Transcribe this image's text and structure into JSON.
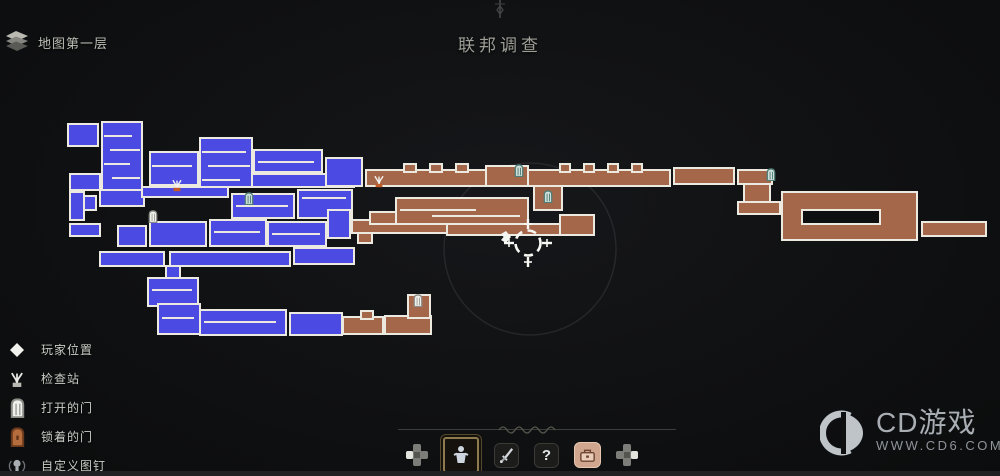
{
  "header": {
    "map_layer_label": "地图第一层",
    "title": "联邦调查"
  },
  "legend": {
    "items": [
      {
        "icon": "player-icon",
        "label": "玩家位置"
      },
      {
        "icon": "checkpoint-icon",
        "label": "检查站"
      },
      {
        "icon": "open-door-icon",
        "label": "打开的门"
      },
      {
        "icon": "locked-door-icon",
        "label": "锁着的门"
      },
      {
        "icon": "custom-pin-icon",
        "label": "自定义图钉"
      }
    ]
  },
  "toolbar": {
    "help_glyph": "?"
  },
  "watermark": {
    "title": "CD游戏",
    "url": "WWW.CD6.COM"
  },
  "map": {
    "colors": {
      "blue": "#4b4ae2",
      "brown": "#a5674a",
      "border": "#ece9e0",
      "door_teal": "#cfe0da",
      "door_teal_stroke": "#4e7d75",
      "checkpoint_orange": "#c25a28",
      "background": "#0e0f10"
    },
    "rooms": [
      [
        68,
        124,
        30,
        22,
        "b"
      ],
      [
        102,
        122,
        40,
        68,
        "b"
      ],
      [
        70,
        174,
        30,
        16,
        "b"
      ],
      [
        70,
        192,
        14,
        28,
        "b"
      ],
      [
        84,
        196,
        12,
        14,
        "b"
      ],
      [
        70,
        224,
        30,
        12,
        "b"
      ],
      [
        100,
        190,
        44,
        16,
        "b"
      ],
      [
        118,
        226,
        28,
        20,
        "b"
      ],
      [
        100,
        252,
        64,
        14,
        "b"
      ],
      [
        150,
        222,
        56,
        24,
        "b"
      ],
      [
        150,
        152,
        48,
        33,
        "b"
      ],
      [
        142,
        187,
        86,
        10,
        "b"
      ],
      [
        200,
        138,
        52,
        49,
        "b"
      ],
      [
        254,
        150,
        68,
        22,
        "b"
      ],
      [
        252,
        174,
        102,
        13,
        "b"
      ],
      [
        326,
        158,
        36,
        28,
        "b"
      ],
      [
        232,
        194,
        62,
        24,
        "b"
      ],
      [
        298,
        190,
        54,
        28,
        "b"
      ],
      [
        210,
        220,
        56,
        26,
        "b"
      ],
      [
        268,
        222,
        58,
        24,
        "b"
      ],
      [
        328,
        210,
        22,
        28,
        "b"
      ],
      [
        170,
        252,
        120,
        14,
        "b"
      ],
      [
        294,
        248,
        60,
        16,
        "b"
      ],
      [
        166,
        266,
        14,
        14,
        "b"
      ],
      [
        148,
        278,
        50,
        28,
        "b"
      ],
      [
        158,
        304,
        42,
        30,
        "b"
      ],
      [
        200,
        310,
        86,
        25,
        "b"
      ],
      [
        290,
        313,
        52,
        22,
        "b"
      ],
      [
        352,
        220,
        96,
        13,
        "r"
      ],
      [
        358,
        233,
        14,
        10,
        "r"
      ],
      [
        366,
        170,
        120,
        16,
        "r"
      ],
      [
        404,
        164,
        12,
        8,
        "r"
      ],
      [
        430,
        164,
        12,
        8,
        "r"
      ],
      [
        456,
        164,
        12,
        8,
        "r"
      ],
      [
        486,
        166,
        42,
        20,
        "r"
      ],
      [
        528,
        170,
        142,
        16,
        "r"
      ],
      [
        560,
        164,
        10,
        8,
        "r"
      ],
      [
        584,
        164,
        10,
        8,
        "r"
      ],
      [
        608,
        164,
        10,
        8,
        "r"
      ],
      [
        632,
        164,
        10,
        8,
        "r"
      ],
      [
        534,
        186,
        28,
        24,
        "r"
      ],
      [
        674,
        168,
        60,
        16,
        "r"
      ],
      [
        738,
        170,
        34,
        14,
        "r"
      ],
      [
        744,
        184,
        26,
        20,
        "r"
      ],
      [
        738,
        202,
        42,
        12,
        "r"
      ],
      [
        782,
        192,
        135,
        48,
        "r"
      ],
      [
        922,
        222,
        64,
        14,
        "r"
      ],
      [
        396,
        198,
        132,
        26,
        "r"
      ],
      [
        370,
        212,
        26,
        12,
        "r"
      ],
      [
        447,
        224,
        130,
        11,
        "r"
      ],
      [
        560,
        215,
        34,
        20,
        "r"
      ],
      [
        343,
        317,
        40,
        17,
        "r"
      ],
      [
        361,
        311,
        12,
        8,
        "r"
      ],
      [
        385,
        316,
        46,
        18,
        "r"
      ],
      [
        408,
        295,
        22,
        23,
        "r"
      ]
    ],
    "voids": [
      [
        802,
        210,
        78,
        14
      ]
    ],
    "platforms": [
      [
        104,
        136,
        28
      ],
      [
        110,
        150,
        30
      ],
      [
        104,
        164,
        26
      ],
      [
        112,
        178,
        28
      ],
      [
        152,
        166,
        40
      ],
      [
        202,
        152,
        44
      ],
      [
        208,
        166,
        42
      ],
      [
        202,
        180,
        38
      ],
      [
        258,
        162,
        56
      ],
      [
        236,
        206,
        52
      ],
      [
        214,
        232,
        46
      ],
      [
        272,
        234,
        48
      ],
      [
        302,
        198,
        44
      ],
      [
        400,
        210,
        76
      ],
      [
        432,
        216,
        88
      ],
      [
        152,
        290,
        40
      ],
      [
        162,
        318,
        32
      ],
      [
        204,
        322,
        72
      ]
    ],
    "icons": [
      [
        "checkpoint",
        170,
        177
      ],
      [
        "checkpoint",
        372,
        173
      ],
      [
        "door_open",
        148,
        210
      ],
      [
        "door",
        244,
        192
      ],
      [
        "door",
        514,
        164
      ],
      [
        "door",
        543,
        190
      ],
      [
        "door",
        766,
        168
      ],
      [
        "door_open",
        413,
        294
      ]
    ],
    "player": {
      "x": 506,
      "y": 237
    },
    "crosshair": {
      "x": 528,
      "y": 243
    },
    "focus_ring": {
      "x": 530,
      "y": 249,
      "r": 86
    }
  }
}
